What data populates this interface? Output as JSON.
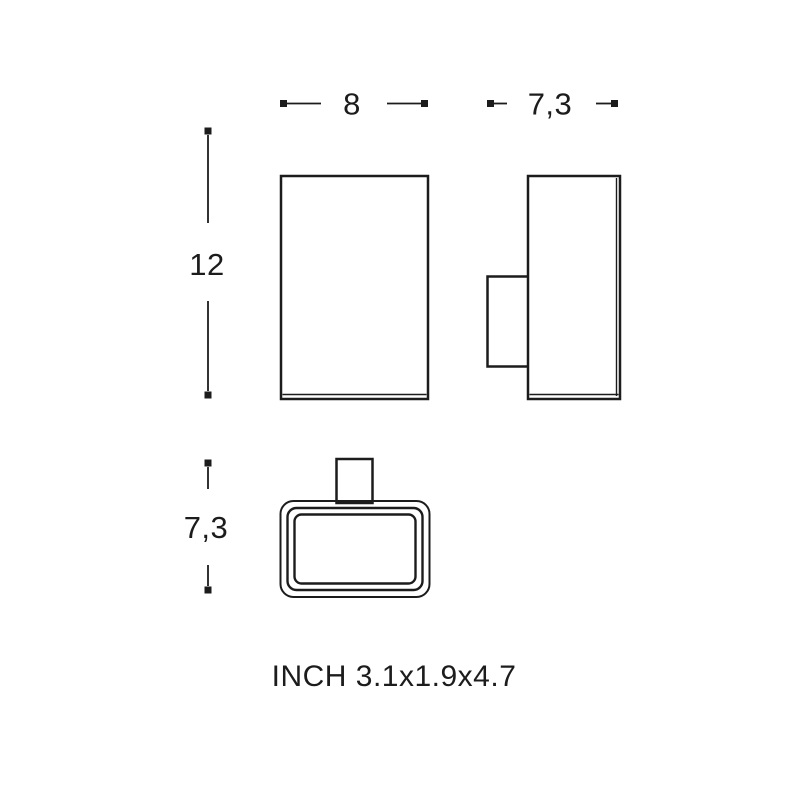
{
  "drawing": {
    "background_color": "#ffffff",
    "line_color": "#1c1c1c",
    "text_color": "#1c1c1c",
    "dimensions": {
      "front_width": "8",
      "side_depth": "7,3",
      "height": "12",
      "plan_depth": "7,3"
    },
    "caption": "INCH 3.1x1.9x4.7"
  }
}
